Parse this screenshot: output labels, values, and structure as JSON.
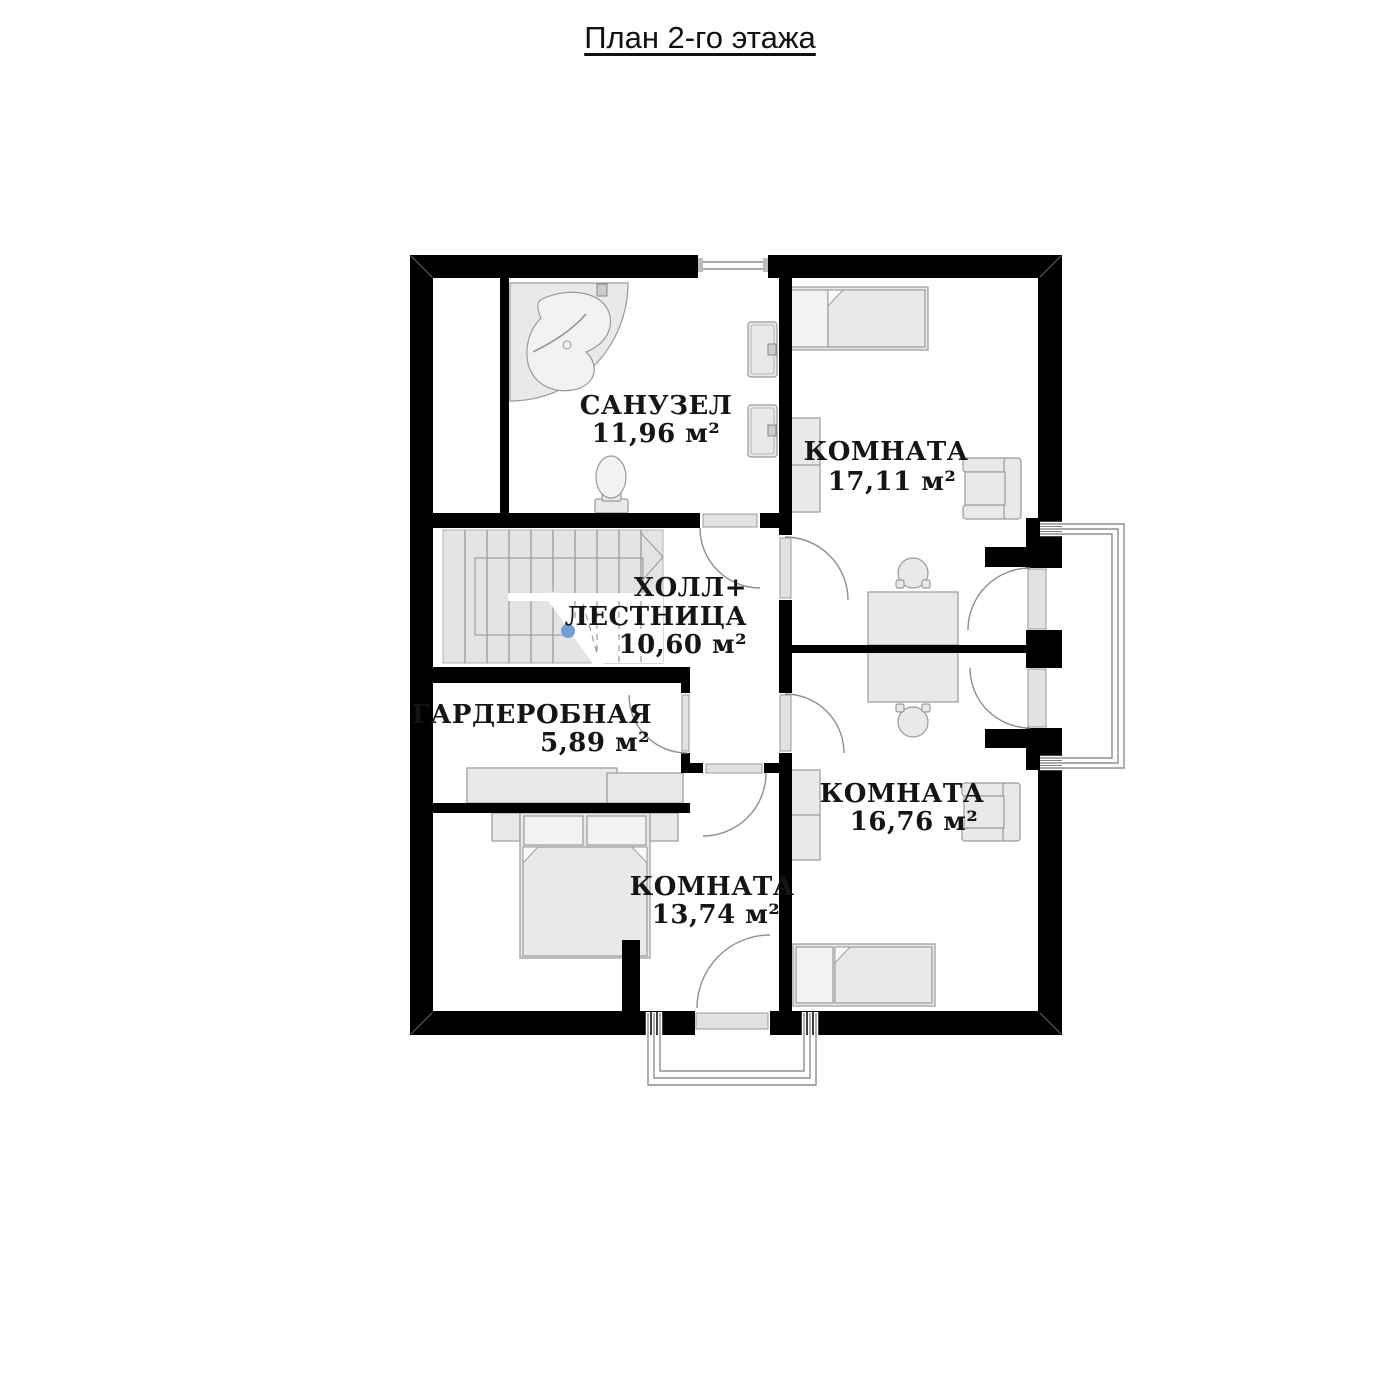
{
  "title": "План 2-го этажа",
  "colors": {
    "wall": "#000000",
    "furn_fill": "#e9e9e9",
    "furn_stroke": "#9a9a9a",
    "stairs_fill": "#e4e4e4",
    "plan_line": "#8f8f8f",
    "leaf_fill": "#e2e2e2",
    "dot_blue": "#6f9ed9",
    "text_color": "#151515"
  },
  "rooms": [
    {
      "id": "bathroom",
      "name": "САНУЗЕЛ",
      "area": "11,96 м²"
    },
    {
      "id": "room-17",
      "name": "КОМНАТА",
      "area": "17,11 м²"
    },
    {
      "id": "hall",
      "name_line1": "ХОЛЛ+",
      "name_line2": "ЛЕСТНИЦА",
      "area": "10,60 м²"
    },
    {
      "id": "wardrobe",
      "name": "ГАРДЕРОБНАЯ",
      "area": "5,89 м²"
    },
    {
      "id": "room-16",
      "name": "КОМНАТА",
      "area": "16,76 м²"
    },
    {
      "id": "room-13",
      "name": "КОМНАТА",
      "area": "13,74 м²"
    }
  ]
}
